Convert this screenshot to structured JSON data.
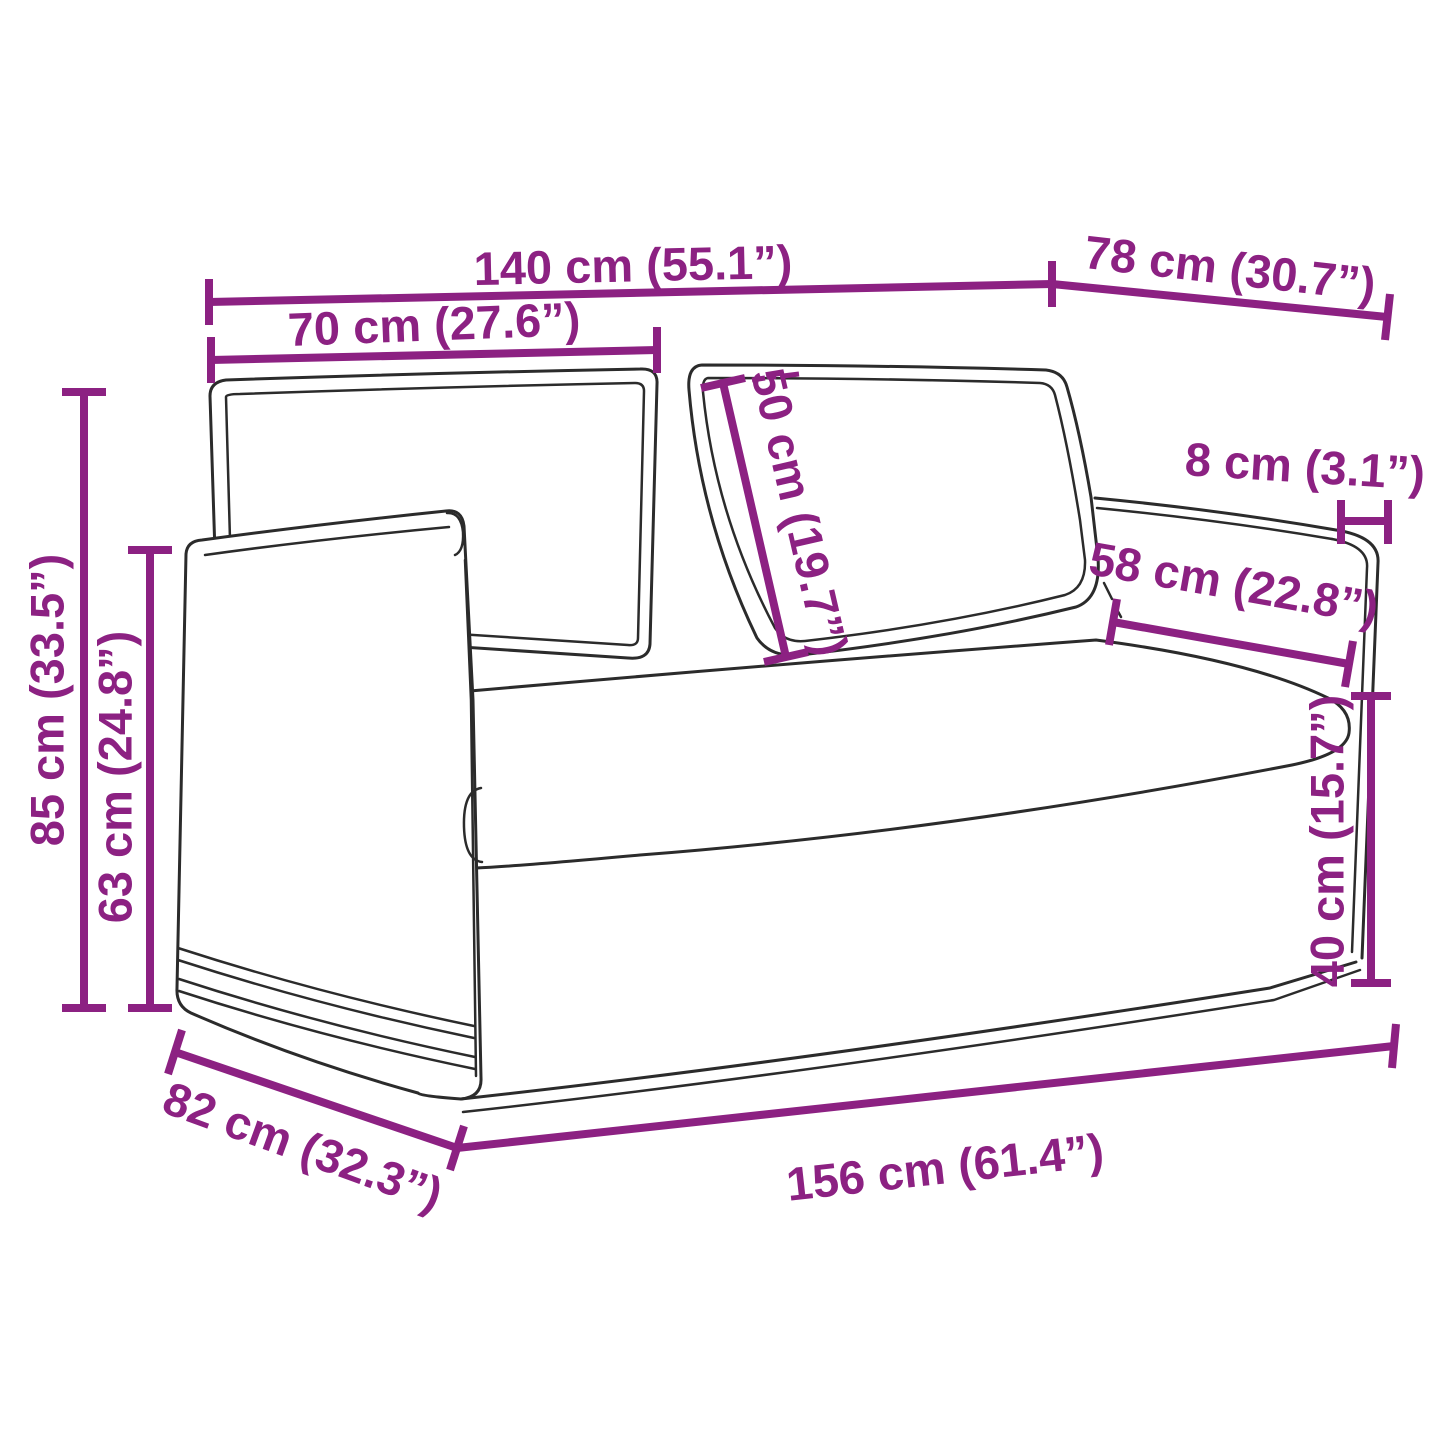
{
  "diagram": {
    "type": "product-dimension-diagram",
    "subject": "two-seater sofa line drawing with measurement annotations",
    "unit_system": "cm (inches)",
    "line_color": "#8C2182",
    "sketch_color": "#2b2b2b",
    "background": "#ffffff",
    "dimensions": [
      {
        "id": "overall-width-top",
        "label": "140 cm (55.1”)",
        "value_cm": 140,
        "value_in": 55.1
      },
      {
        "id": "top-depth",
        "label": "78 cm (30.7”)",
        "value_cm": 78,
        "value_in": 30.7
      },
      {
        "id": "half-width",
        "label": "70 cm (27.6”)",
        "value_cm": 70,
        "value_in": 27.6
      },
      {
        "id": "back-cushion-height",
        "label": "50 cm (19.7”)",
        "value_cm": 50,
        "value_in": 19.7
      },
      {
        "id": "armrest-width",
        "label": "8 cm (3.1”)",
        "value_cm": 8,
        "value_in": 3.1
      },
      {
        "id": "seat-depth",
        "label": "58 cm (22.8”)",
        "value_cm": 58,
        "value_in": 22.8
      },
      {
        "id": "total-height",
        "label": "85 cm (33.5”)",
        "value_cm": 85,
        "value_in": 33.5
      },
      {
        "id": "armrest-height",
        "label": "63 cm (24.8”)",
        "value_cm": 63,
        "value_in": 24.8
      },
      {
        "id": "seat-height",
        "label": "40 cm (15.7”)",
        "value_cm": 40,
        "value_in": 15.7
      },
      {
        "id": "base-depth",
        "label": "82 cm (32.3”)",
        "value_cm": 82,
        "value_in": 32.3
      },
      {
        "id": "base-width",
        "label": "156 cm (61.4”)",
        "value_cm": 156,
        "value_in": 61.4
      }
    ]
  }
}
